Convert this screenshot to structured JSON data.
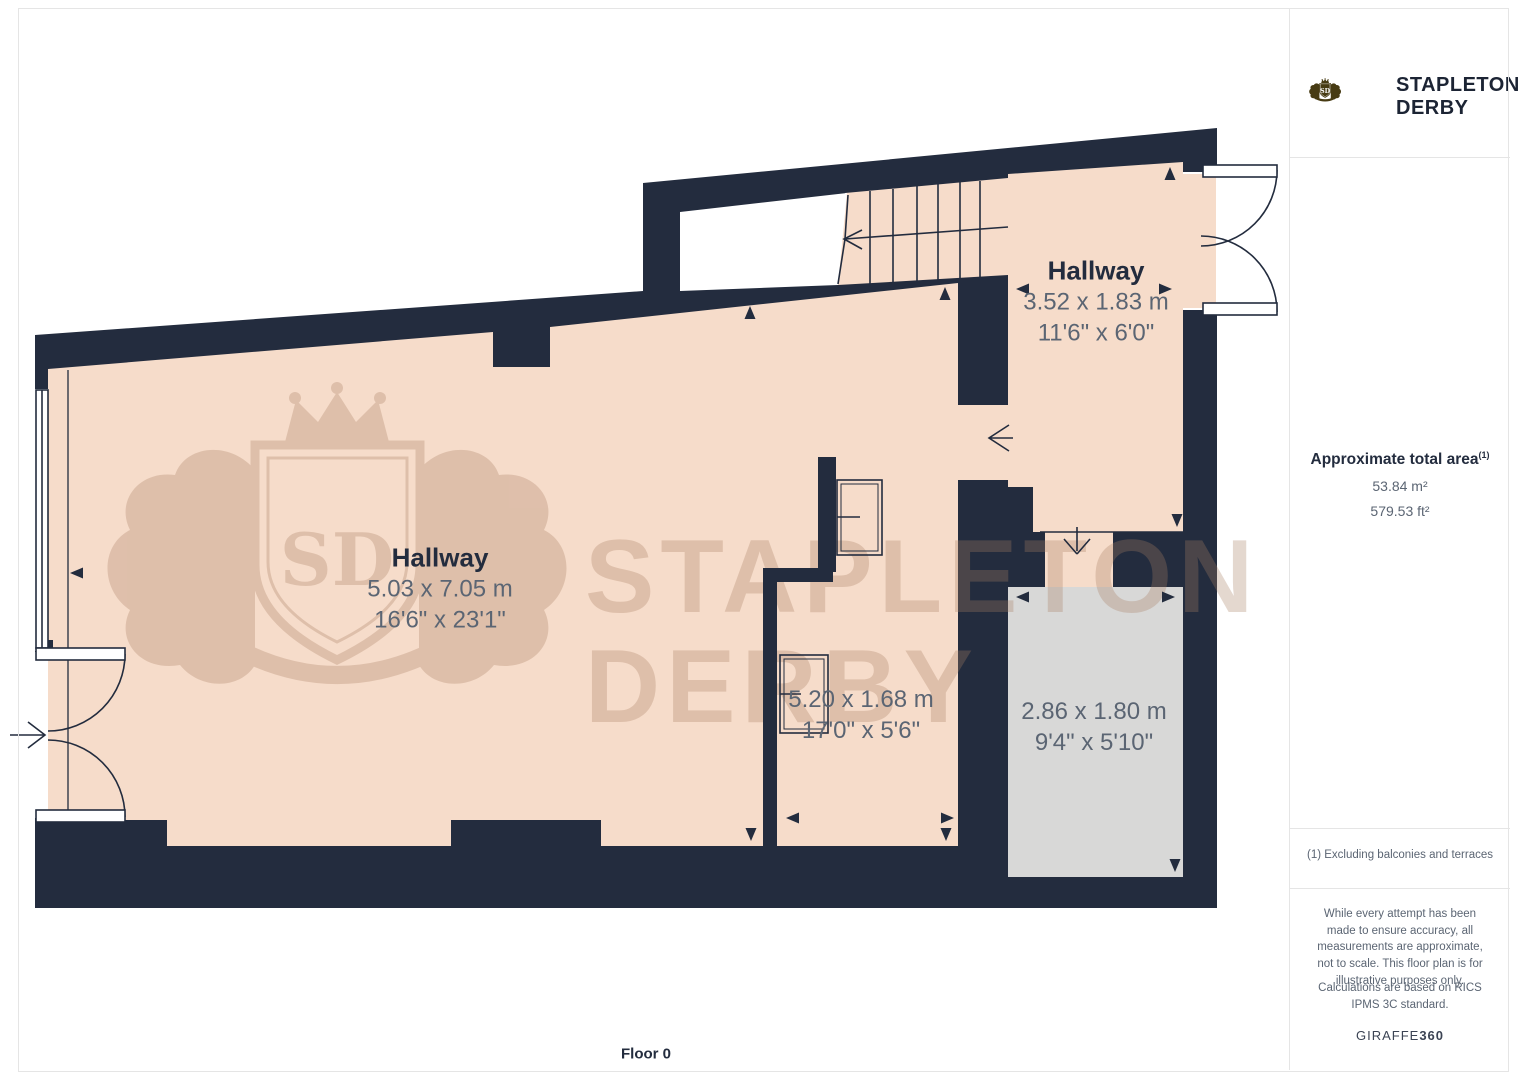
{
  "floorplan": {
    "floor_label": "Floor 0",
    "rooms": [
      {
        "name": "Hallway",
        "metric": "5.03 x 7.05 m",
        "imperial": "16'6\" x 23'1\""
      },
      {
        "name": "Hallway",
        "metric": "3.52 x 1.83 m",
        "imperial": "11'6\" x 6'0\""
      },
      {
        "name": "",
        "metric": "5.20 x 1.68 m",
        "imperial": "17'0\" x 5'6\""
      },
      {
        "name": "",
        "metric": "2.86 x 1.80 m",
        "imperial": "9'4\" x 5'10\""
      }
    ],
    "watermark": {
      "line1": "STAPLETON",
      "line2": "DERBY",
      "monogram": "SD"
    },
    "colors": {
      "wall": "#232c3e",
      "floor": "#f6dcca",
      "gray_room": "#d8d8d7",
      "room_name_text": "#232c3e",
      "dimension_text": "#5b6573",
      "watermark": "#a97f63"
    }
  },
  "sidebar": {
    "brand": {
      "line1": "STAPLETON",
      "line2": "DERBY",
      "monogram": "SD",
      "color": "#473b13"
    },
    "area": {
      "title": "Approximate total area",
      "superscript": "(1)",
      "metric": "53.84 m²",
      "imperial": "579.53 ft²"
    },
    "note": "(1) Excluding balconies and terraces",
    "disclaimer1": "While every attempt has been made to ensure accuracy, all measurements are approximate, not to scale. This floor plan is for illustrative purposes only.",
    "disclaimer2": "Calculations are based on RICS IPMS 3C standard.",
    "vendor": {
      "name": "GIRAFFE",
      "suffix": "360"
    }
  }
}
